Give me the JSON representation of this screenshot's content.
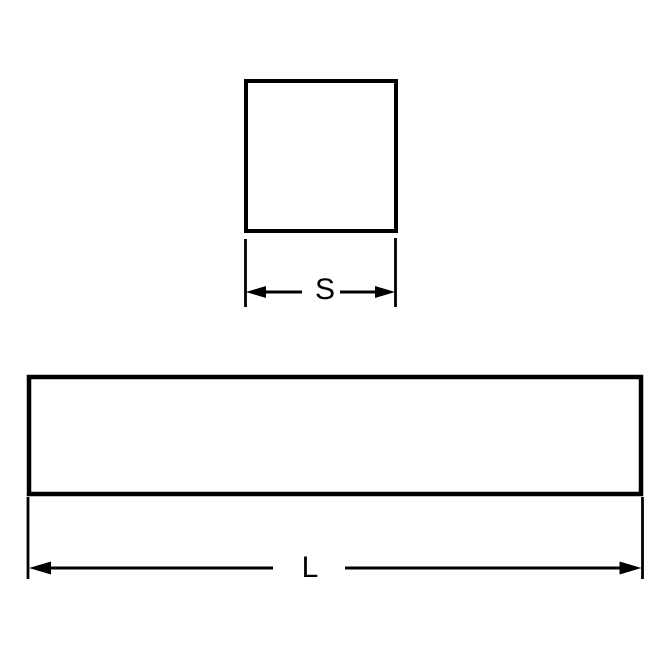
{
  "diagram": {
    "background_color": "#ffffff",
    "line_color": "#000000",
    "views": {
      "cross_section": {
        "shape": "square",
        "dimension_label": "S"
      },
      "side_view": {
        "shape": "rectangle",
        "dimension_label": "L"
      }
    }
  }
}
